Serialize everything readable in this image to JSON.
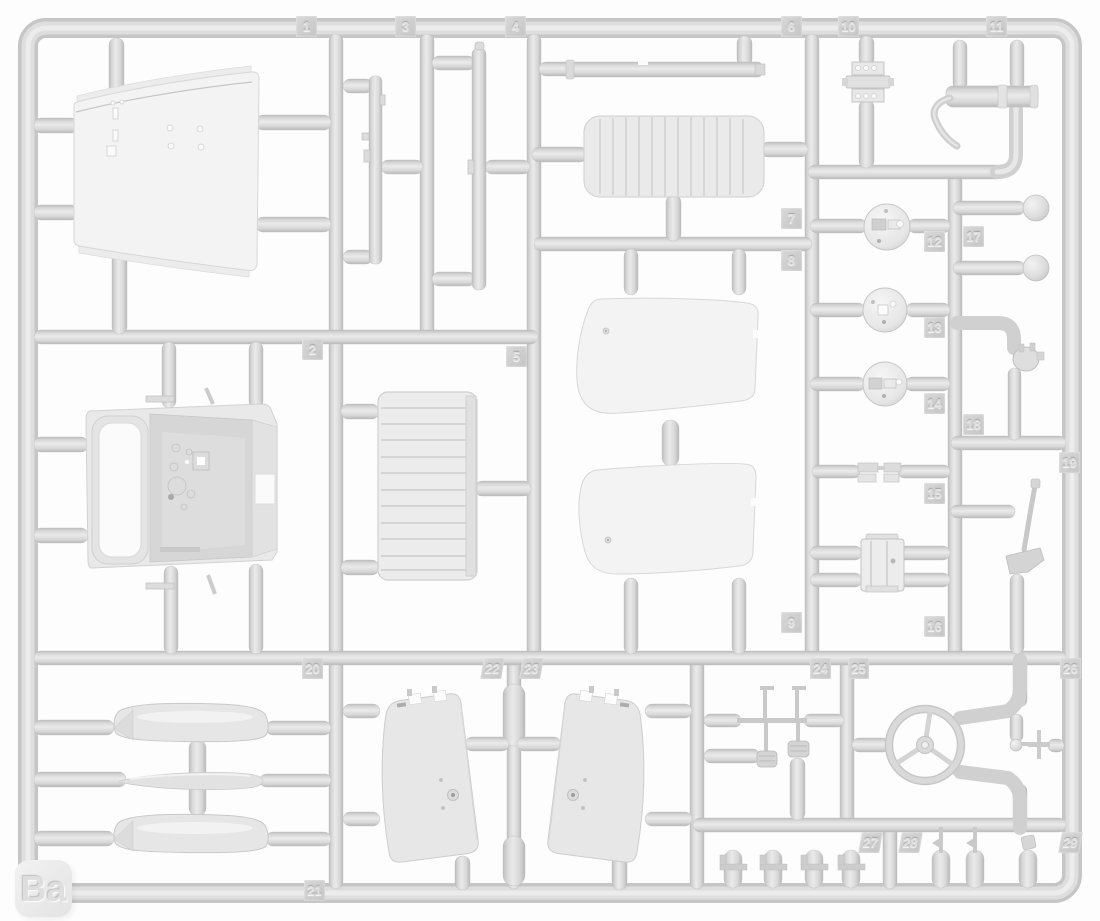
{
  "sprue": {
    "set_label": "Ba",
    "part_numbers": [
      "1",
      "2",
      "3",
      "4",
      "5",
      "6",
      "7",
      "8",
      "9",
      "10",
      "11",
      "12",
      "13",
      "14",
      "15",
      "16",
      "17",
      "18",
      "19",
      "20",
      "21",
      "22",
      "23",
      "24",
      "25",
      "26",
      "27",
      "28",
      "29"
    ]
  },
  "tags": [
    {
      "number": "1"
    },
    {
      "number": "3"
    },
    {
      "number": "4"
    },
    {
      "number": "6"
    },
    {
      "number": "10"
    },
    {
      "number": "11"
    },
    {
      "number": "7"
    },
    {
      "number": "8"
    },
    {
      "number": "9"
    },
    {
      "number": "12"
    },
    {
      "number": "17"
    },
    {
      "number": "13"
    },
    {
      "number": "14"
    },
    {
      "number": "18"
    },
    {
      "number": "15"
    },
    {
      "number": "16"
    },
    {
      "number": "19"
    },
    {
      "number": "2"
    },
    {
      "number": "5"
    },
    {
      "number": "20"
    },
    {
      "number": "22"
    },
    {
      "number": "23"
    },
    {
      "number": "24"
    },
    {
      "number": "25"
    },
    {
      "number": "26"
    },
    {
      "number": "27"
    },
    {
      "number": "28"
    },
    {
      "number": "29"
    },
    {
      "number": "21"
    }
  ],
  "colors": {
    "background": "#fdfdfd",
    "plastic": "#d9d9d9",
    "plastic_highlight": "#ededed",
    "plastic_shadow": "#bcbcbc",
    "part_fill": "#f4f4f4"
  }
}
